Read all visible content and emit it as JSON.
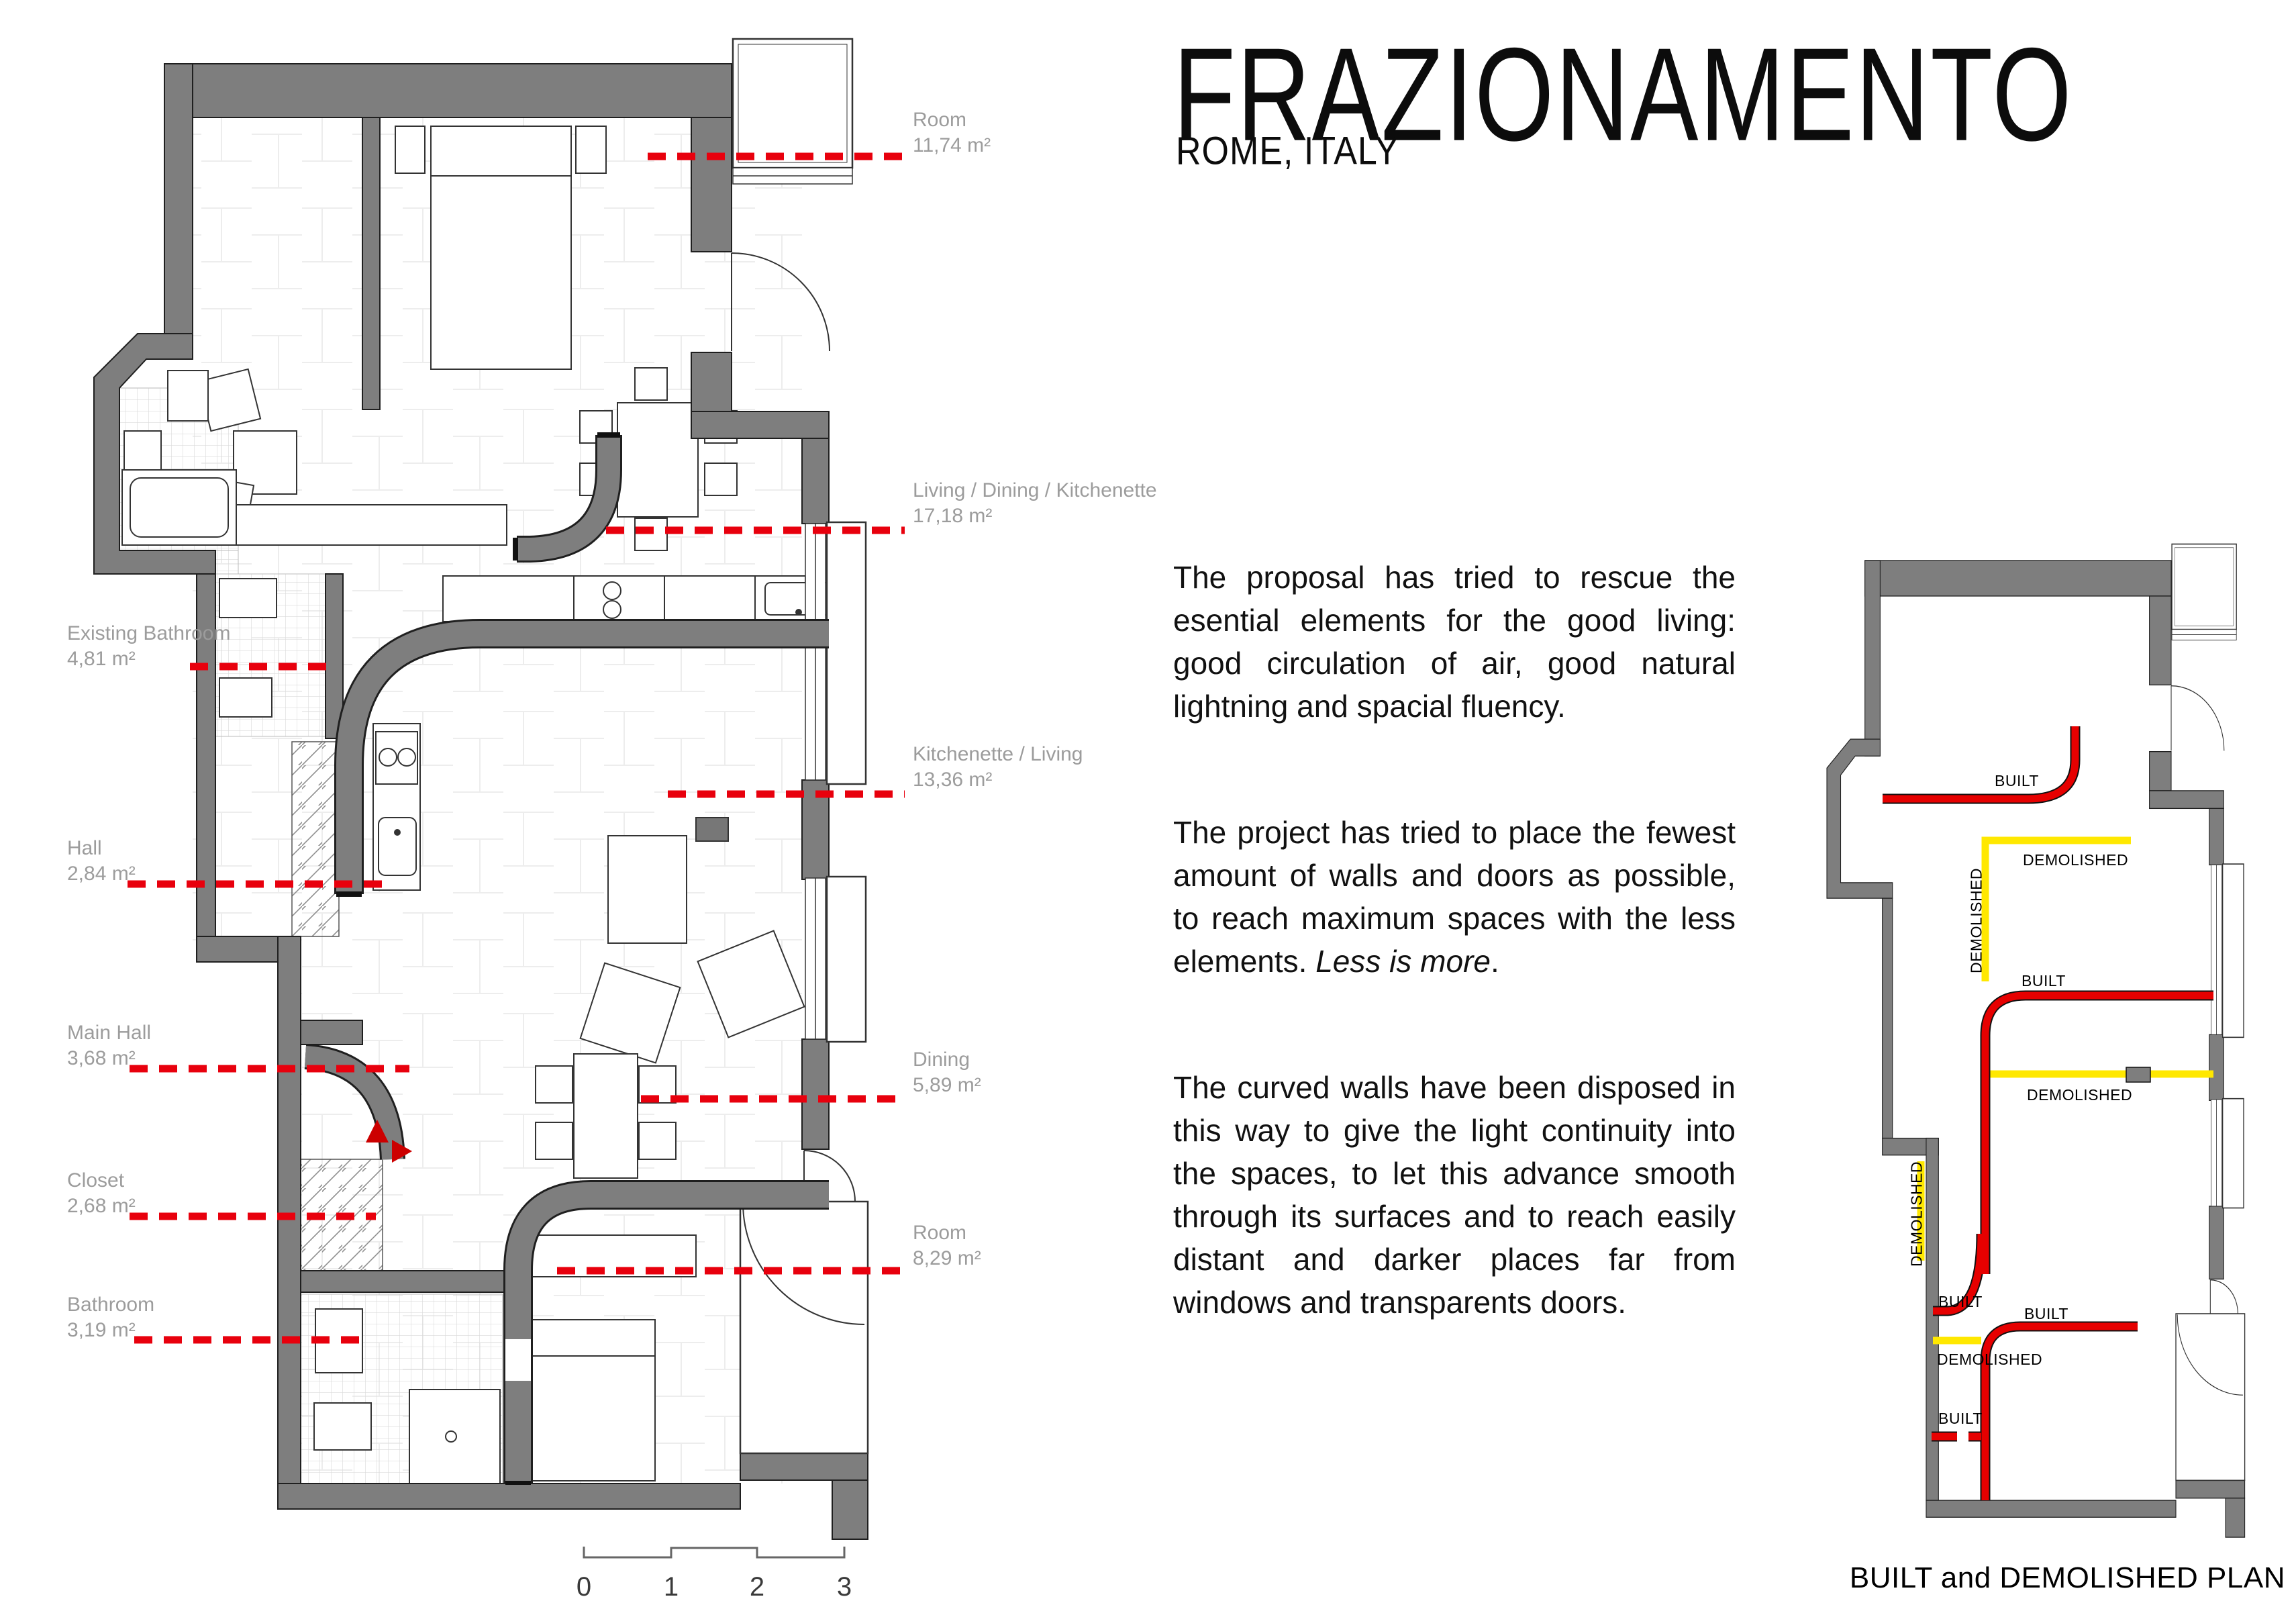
{
  "title": {
    "main": "FRAZIONAMENTO",
    "subtitle": "ROME, ITALY"
  },
  "description": {
    "p1": "The proposal has tried to rescue the esential elements for the good living: good circulation of air, good natural lightning and spacial fluency.",
    "p2_start": "The project has tried to place the fewest amount of walls and doors as possible, to reach maximum spaces with the less elements. ",
    "p2_italic": "Less is more",
    "p2_end": ".",
    "p3": "The curved walls have been disposed in this way to give the light continuity into the spaces, to let this advance smooth through its surfaces and to reach easily distant and darker places far from windows and transparents doors."
  },
  "floor_plan": {
    "rooms": [
      {
        "name": "Room",
        "area": "11,74 m²"
      },
      {
        "name": "Living / Dining / Kitchenette",
        "area": "17,18 m²"
      },
      {
        "name": "Kitchenette / Living",
        "area": "13,36 m²"
      },
      {
        "name": "Dining",
        "area": "5,89 m²"
      },
      {
        "name": "Room",
        "area": "8,29 m²"
      },
      {
        "name": "Existing Bathroom",
        "area": "4,81 m²"
      },
      {
        "name": "Hall",
        "area": "2,84 m²"
      },
      {
        "name": "Main Hall",
        "area": "3,68 m²"
      },
      {
        "name": "Closet",
        "area": "2,68 m²"
      },
      {
        "name": "Bathroom",
        "area": "3,19 m²"
      }
    ]
  },
  "built_demolished_plan": {
    "caption": "BUILT and DEMOLISHED PLAN",
    "built_label": "BUILT",
    "demolished_label": "DEMOLISHED"
  },
  "scale_bar": {
    "ticks": [
      "0",
      "1",
      "2",
      "3"
    ]
  },
  "colors": {
    "wall": "#7e7e7e",
    "built_red": "#e60000",
    "demolished_yellow": "#ffe800",
    "leader_red": "#e8000d",
    "label_gray": "#9c9c9c"
  }
}
